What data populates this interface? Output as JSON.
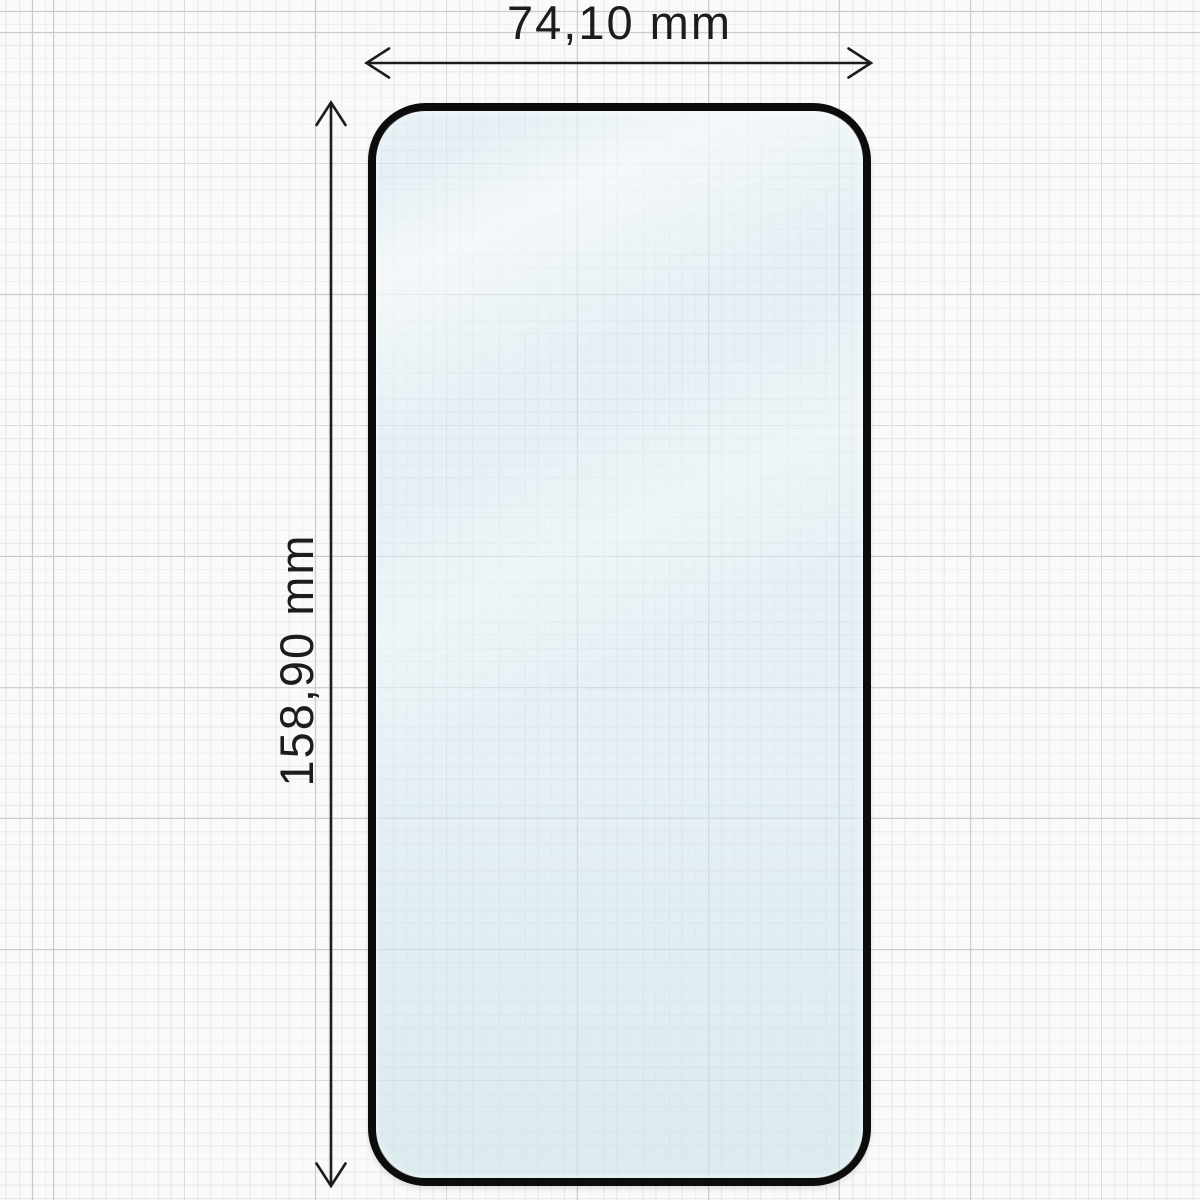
{
  "diagram": {
    "subject": "screen-protector-tempered-glass",
    "width_label": "74,10 mm",
    "height_label": "158,90 mm"
  },
  "colors": {
    "background": "#fafafa",
    "grid_minor": "#e9e9e9",
    "grid_major": "#c9cbcc",
    "glass_border": "#0c0c0c",
    "glass_tint": "#d6e8f08c",
    "dimension_line": "#1c1c1c",
    "label_text": "#1c1c1c"
  }
}
